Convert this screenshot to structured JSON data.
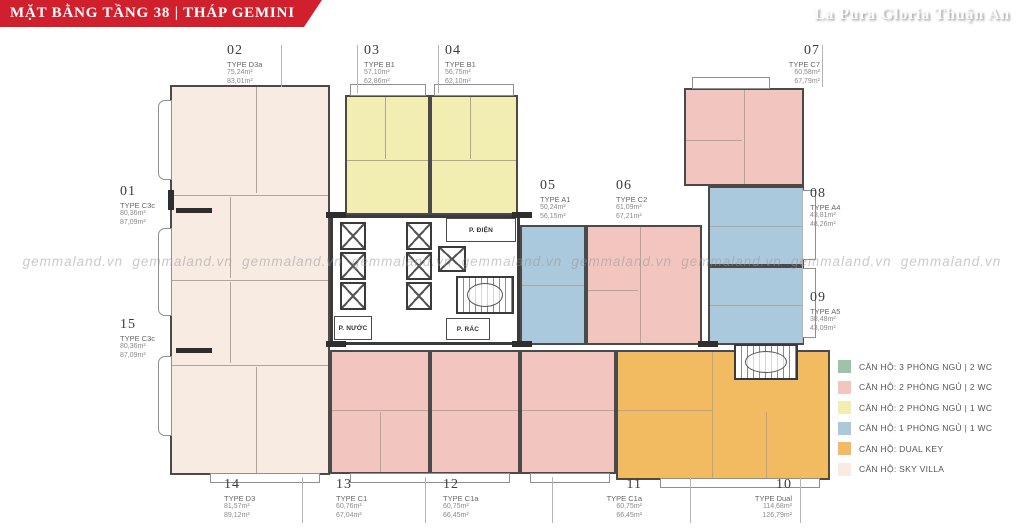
{
  "header": {
    "title": "MẶT BẰNG TẦNG 38 | THÁP GEMINI"
  },
  "brand": "La Pura Gloria Thuận An",
  "watermark": "gemmaland.vn",
  "colors": {
    "banner": "#d0202e",
    "sky_villa": "#f8ebe2",
    "pink_2pn2wc": "#f2c6be",
    "yellow_2pn1wc": "#f2eeb2",
    "blue_1pn1wc": "#abc9dc",
    "orange_dual_key": "#f2bb62",
    "green_3pn2wc": "#9dc4a8",
    "core_white": "#ffffff"
  },
  "core": {
    "electrical_room": "P. ĐIỆN",
    "water_room": "P. NƯỚC",
    "trash_room": "P. RÁC"
  },
  "units": [
    {
      "id": "01",
      "type": "TYPE C3c",
      "area1": "80,36m²",
      "area2": "87,09m²"
    },
    {
      "id": "02",
      "type": "TYPE D3a",
      "area1": "75,24m²",
      "area2": "83,01m²"
    },
    {
      "id": "03",
      "type": "TYPE B1",
      "area1": "57,10m²",
      "area2": "62,86m²"
    },
    {
      "id": "04",
      "type": "TYPE B1",
      "area1": "56,75m²",
      "area2": "62,10m²"
    },
    {
      "id": "05",
      "type": "TYPE A1",
      "area1": "50,24m²",
      "area2": "56,15m²"
    },
    {
      "id": "06",
      "type": "TYPE C2",
      "area1": "61,09m²",
      "area2": "67,21m²"
    },
    {
      "id": "07",
      "type": "TYPE C7",
      "area1": "60,58m²",
      "area2": "67,79m²"
    },
    {
      "id": "08",
      "type": "TYPE A4",
      "area1": "43,81m²",
      "area2": "48,26m²"
    },
    {
      "id": "09",
      "type": "TYPE A5",
      "area1": "38,48m²",
      "area2": "43,09m²"
    },
    {
      "id": "10",
      "type": "TYPE Dual",
      "area1": "114,68m²",
      "area2": "126,79m²"
    },
    {
      "id": "11",
      "type": "TYPE C1a",
      "area1": "60,75m²",
      "area2": "66,45m²"
    },
    {
      "id": "12",
      "type": "TYPE C1a",
      "area1": "60,75m²",
      "area2": "66,45m²"
    },
    {
      "id": "13",
      "type": "TYPE C1",
      "area1": "60,76m²",
      "area2": "67,04m²"
    },
    {
      "id": "14",
      "type": "TYPE D3",
      "area1": "81,57m²",
      "area2": "89,12m²"
    },
    {
      "id": "15",
      "type": "TYPE C3c",
      "area1": "80,36m²",
      "area2": "87,09m²"
    }
  ],
  "legend": [
    {
      "label": "CĂN HỘ: 3 PHÒNG NGỦ | 2 WC",
      "color": "#9dc4a8"
    },
    {
      "label": "CĂN HỘ: 2 PHÒNG NGỦ | 2 WC",
      "color": "#f2c6be"
    },
    {
      "label": "CĂN HỘ: 2 PHÒNG NGỦ | 1 WC",
      "color": "#f2eeb2"
    },
    {
      "label": "CĂN HỘ: 1 PHÒNG NGỦ | 1 WC",
      "color": "#abc9dc"
    },
    {
      "label": "CĂN HỘ: DUAL KEY",
      "color": "#f2bb62"
    },
    {
      "label": "CĂN HỘ: SKY VILLA",
      "color": "#f8ebe2"
    }
  ]
}
